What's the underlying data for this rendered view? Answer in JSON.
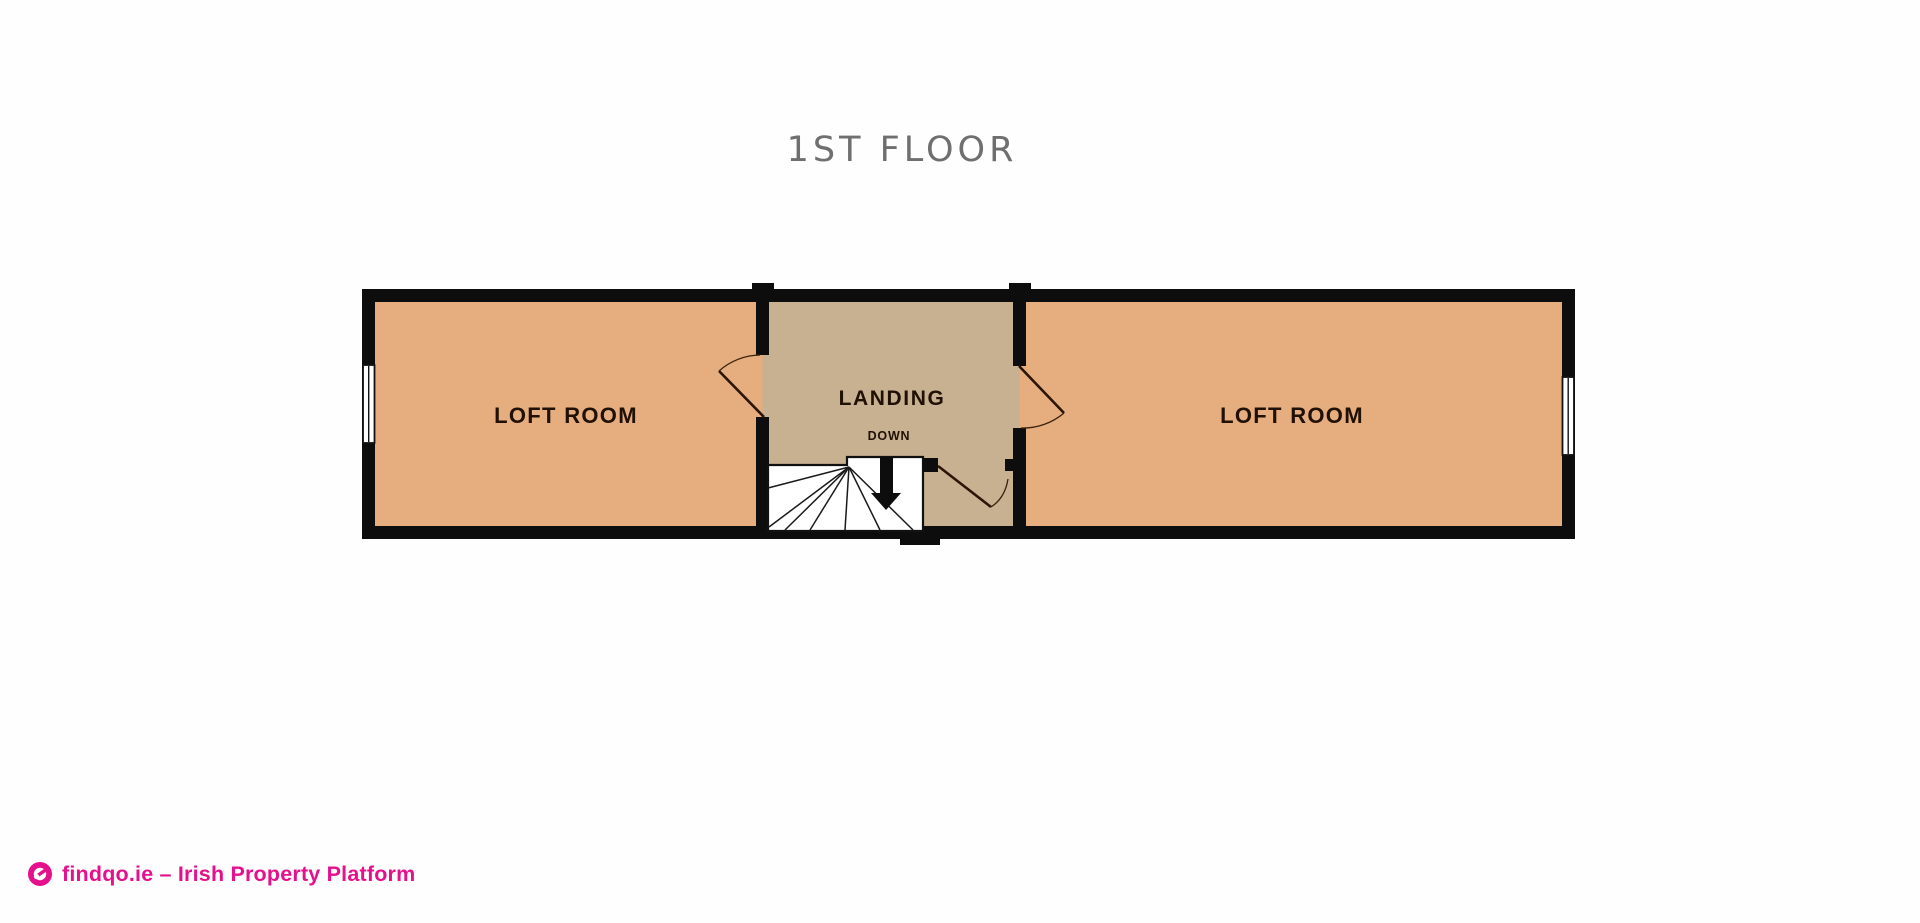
{
  "title": "1ST FLOOR",
  "plan": {
    "left_room_label": "LOFT ROOM",
    "right_room_label": "LOFT ROOM",
    "landing_label": "LANDING",
    "stairs_label": "DOWN"
  },
  "footer": {
    "brand": "findqo.ie – Irish Property Platform"
  },
  "colors": {
    "room_fill": "#e6ad7e",
    "landing_fill": "#c7b191",
    "wall": "#0d0d0d",
    "stairs_fill": "#ffffff",
    "label_text": "#211104",
    "title_text": "#6f6f6f",
    "brand_pink": "#e5108c"
  }
}
